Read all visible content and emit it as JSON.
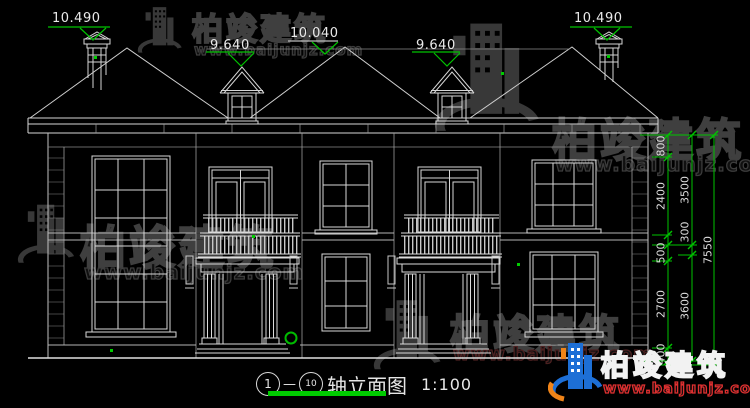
{
  "title": {
    "axis_start": "1",
    "axis_separator": "—",
    "axis_end": "10",
    "name": "轴立面图",
    "scale": "1:100"
  },
  "levels": {
    "chimney_left": "10.490",
    "chimney_right": "10.490",
    "ridge": "10.040",
    "dormer_left": "9.640",
    "dormer_right": "9.640"
  },
  "dimensions": {
    "inner": [
      "800",
      "2400",
      "500",
      "2700",
      "400"
    ],
    "middle": [
      "3500",
      "300",
      "3600"
    ],
    "overall": "7550"
  },
  "watermark": {
    "brand": "柏竣建筑",
    "url": "www.baijunjz.com"
  },
  "logo": {
    "brand": "柏竣建筑",
    "url": "www.baijunjz.com"
  },
  "colors": {
    "background": "#000000",
    "line": "#d9d9d9",
    "accent_green": "#00c300",
    "logo_blue": "#1d6fd6",
    "logo_orange": "#f08418",
    "url_red": "#e03030"
  }
}
